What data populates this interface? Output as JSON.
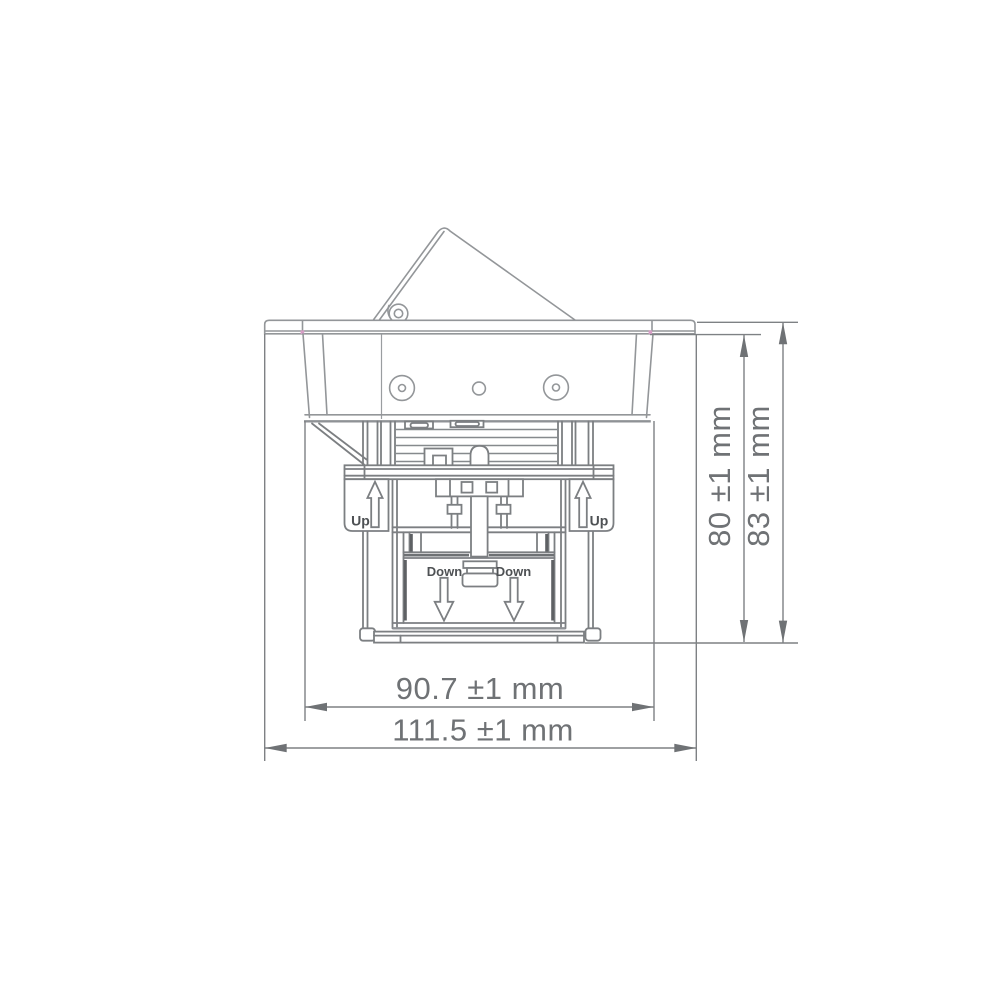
{
  "drawing": {
    "type": "technical-dimension-drawing",
    "annotations": {
      "up_left": "Up",
      "up_right": "Up",
      "down_left": "Down",
      "down_right": "Down"
    },
    "dimensions": {
      "inner_height": "80 ±1 mm",
      "outer_height": "83 ±1 mm",
      "inner_width": "90.7 ±1 mm",
      "outer_width": "111.5 ±1 mm"
    },
    "colors": {
      "background": "#ffffff",
      "line_light": "#939699",
      "line_medium": "#7c7f82",
      "line_dark": "#5e6164",
      "dimension_text": "#6f7275",
      "label_text": "#4e5154",
      "corner_mark": "#d79ec6"
    }
  }
}
